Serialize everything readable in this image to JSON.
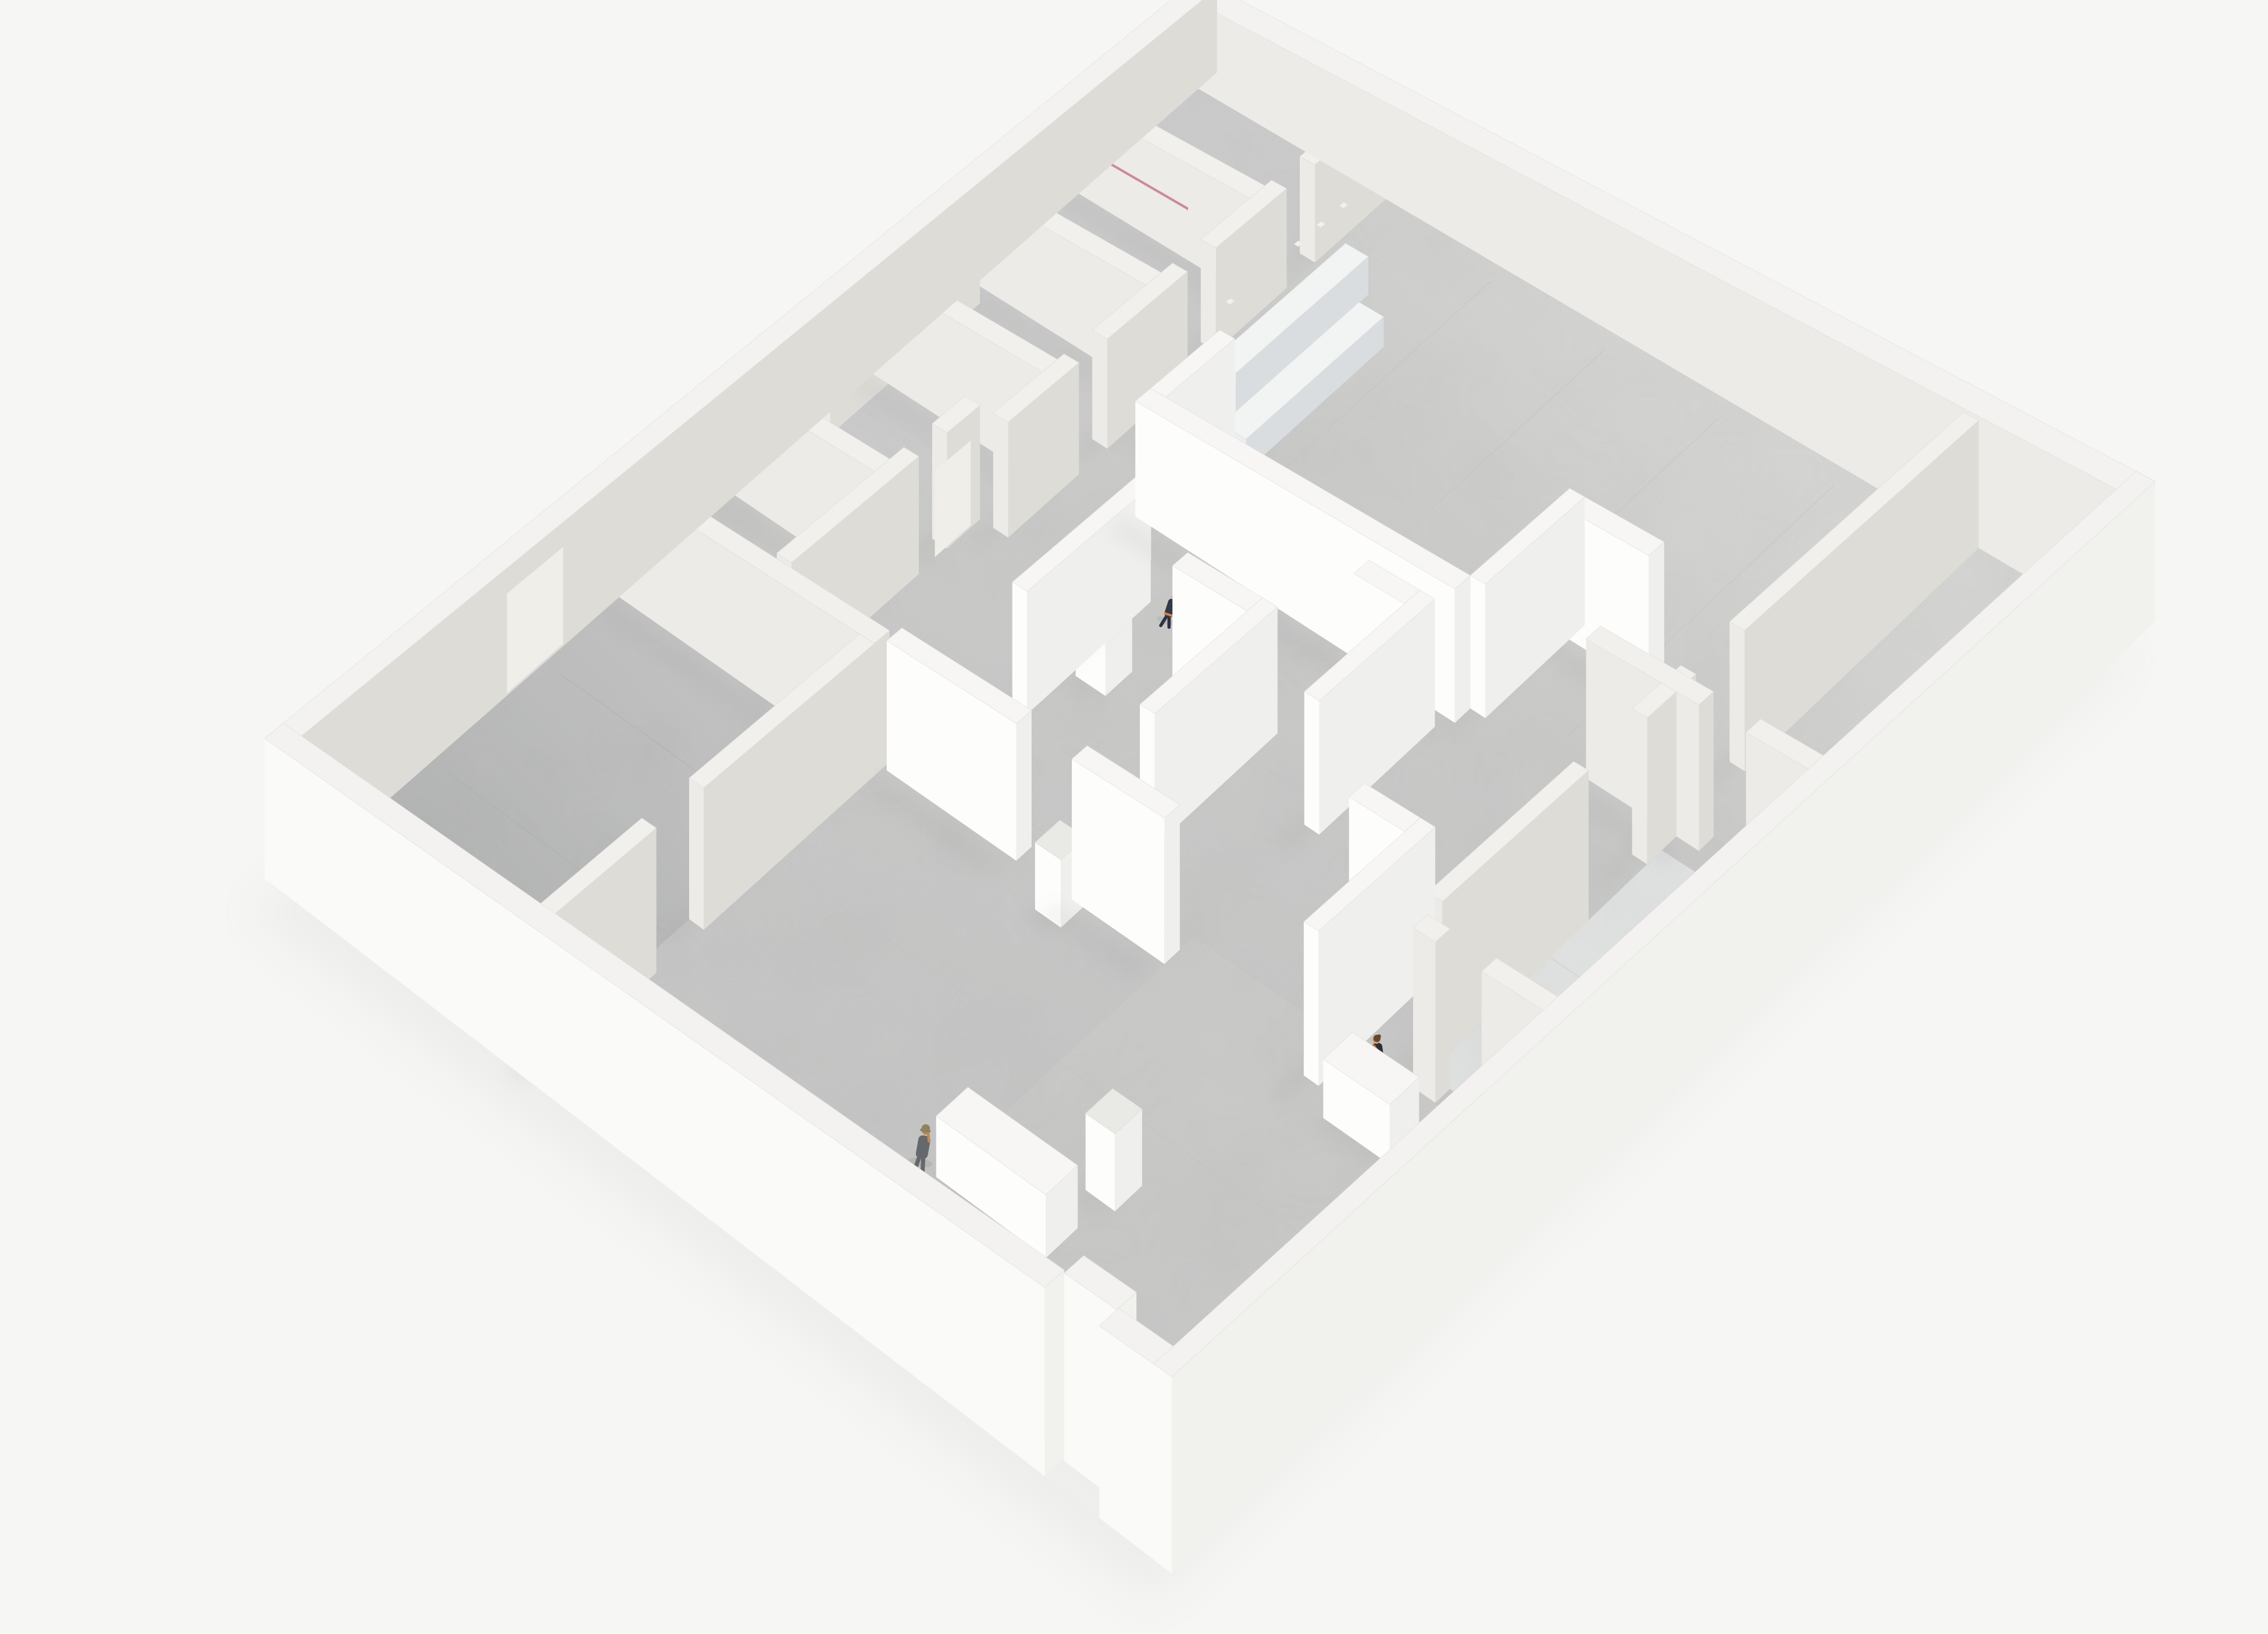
{
  "scene": {
    "description": "Top-down axonometric cutaway render of a white gallery / museum floor-plan model with concrete shell walls, white partition walls, gray concrete floors and four miniature human figures",
    "style": "architectural model render",
    "text_visible": false,
    "figure_count": 4
  },
  "colors": {
    "background": "#f6f6f5",
    "exterior_face": "#fafaf9",
    "exterior_face_shaded": "#f1f1ee",
    "wall_top": "#f3f2f0",
    "concrete_face": "#ecebe7",
    "concrete_face_shaded": "#dedcd7",
    "concrete_top": "#f1f0ed",
    "partition_face": "#fdfdfc",
    "partition_face_shaded": "#efefee",
    "partition_top": "#f7f6f4",
    "plinth_top": "#e9e9e6",
    "counter_face": "#eceff0",
    "counter_face_shaded": "#d9dde0",
    "counter_top": "#f2f4f4",
    "floor_main_a": "#cbccca",
    "floor_main_b": "#c2c3c2",
    "floor_gallery_a": "#d4d4d2",
    "floor_gallery_b": "#c8c9c7",
    "floor_corner_room": "#e0e1e1",
    "floor_wing": "#c9cac9",
    "floor_dark_a": "#c1c2c1",
    "floor_dark_b": "#afb0b0",
    "shadow": "#8e8e8c",
    "accent_pink": "#c4708c",
    "accent_red": "#a83444",
    "panel_brown": "#47331f",
    "door_leaf": "#efeee9",
    "dark_furniture": "#43464b",
    "post": "#e8e8e5"
  },
  "figures": [
    {
      "id": "figure-receptionist",
      "desc": "seated figure behind reception counter",
      "shirt": "#b26a34",
      "hair": "#3f2d1d",
      "skin": "#c9a07a",
      "chair": "#2f3136",
      "pos": {
        "u": 0.283,
        "v": 0.197
      }
    },
    {
      "id": "figure-visitor-walking",
      "desc": "visitor walking along the long partition wall",
      "top": "#333948",
      "pants": "#2c3245",
      "bag": "#cfc7b4",
      "accent": "#dd8040",
      "hair": "#53331e",
      "skin": "#c9a07a",
      "pos": {
        "u": 0.37,
        "v": 0.405
      }
    },
    {
      "id": "figure-visitor-gallery",
      "desc": "visitor standing in a partition niche",
      "top": "#2e2e34",
      "strap": "#dd7a36",
      "hair": "#6a4527",
      "skin": "#c9a07a",
      "pos": {
        "u": 0.8,
        "v": 0.6
      }
    },
    {
      "id": "figure-visitor-photographer",
      "desc": "figure in gray with hat, arm raised to face",
      "suit": "#65686c",
      "hat": "#8e8260",
      "shoes": "#26262a",
      "skin": "#c08a54",
      "pos": {
        "u": 0.58,
        "v": 0.865
      }
    }
  ],
  "objects": {
    "reception_counters": 2,
    "counter_posts": 6,
    "display_plinths": 4,
    "freestanding_partitions": 9,
    "display_cases": 2,
    "wall_tabs": 5,
    "doors": 2,
    "small_rooms": 6
  }
}
